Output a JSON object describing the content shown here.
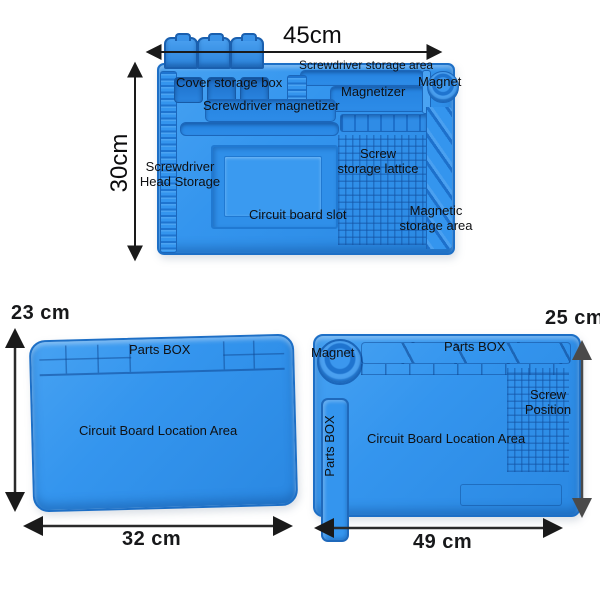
{
  "colors": {
    "mat_blue": "#3495EE",
    "mat_blue_dark": "#1D6FC6",
    "tray_blue": "#2583E0",
    "background": "#FFFFFF",
    "label_text": "#0F1012",
    "arrow": "#1A1A1A"
  },
  "top_mat": {
    "dim_width": "45cm",
    "dim_height": "30cm",
    "labels": {
      "screwdriver_storage_area": "Screwdriver storage area",
      "cover_storage_box": "Cover storage box",
      "magnetizer": "Magnetizer",
      "magnet": "Magnet",
      "screwdriver_magnetizer": "Screwdriver magnetizer",
      "screwdriver_head_storage_line1": "Screwdriver",
      "screwdriver_head_storage_line2": "Head Storage",
      "screw_storage_lattice_line1": "Screw",
      "screw_storage_lattice_line2": "storage lattice",
      "circuit_board_slot": "Circuit board slot",
      "magnetic_storage_area_line1": "Magnetic",
      "magnetic_storage_area_line2": "storage area"
    }
  },
  "bottom_left_mat": {
    "dim_width": "32 cm",
    "dim_height": "23 cm",
    "labels": {
      "parts_box": "Parts BOX",
      "circuit_board_location_area": "Circuit Board Location Area"
    }
  },
  "bottom_right_mat": {
    "dim_width": "49 cm",
    "dim_height": "25 cm",
    "labels": {
      "magnet": "Magnet",
      "parts_box_top": "Parts BOX",
      "parts_box_side": "Parts BOX",
      "circuit_board_location_area": "Circuit Board Location Area",
      "screw_position_line1": "Screw",
      "screw_position_line2": "Position"
    }
  }
}
